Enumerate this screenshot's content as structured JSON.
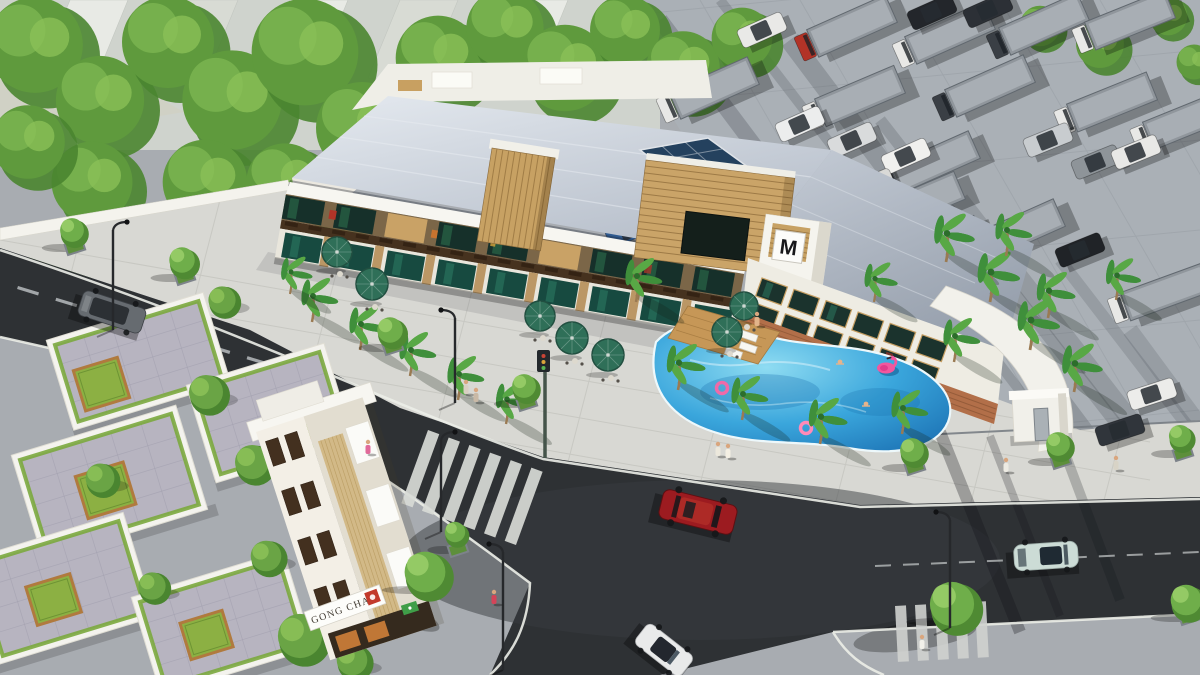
{
  "scene_title": "Aerial 3D architectural rendering: mixed-use commercial building with pool, street corner, villas and truck parking lot",
  "signs": {
    "shop_sign": "GONG CHA",
    "building_logo": "M"
  },
  "palette": {
    "asphalt": "#2e3134",
    "sidewalk": "#d8d8d3",
    "parking_lot": "#aab0b6",
    "pool_water": "#2e9ad2",
    "umbrella_green": "#2f6f58",
    "flamingo_pink": "#f2579e",
    "tree_green": "#5f9a3d",
    "palm_green": "#3f8f3b",
    "wood_slat": "#c9a266",
    "metal_roof": "#c3ccd7",
    "villa_paver": "#b7b4c0",
    "courtyard_green": "#8cb043",
    "red_car": "#9c1b20",
    "convertible_car": "#ccdcd6",
    "sports_car": "#e9eaea",
    "minivan": "#666b70",
    "truck_gray": "#90969c"
  },
  "vehicles": {
    "box_trucks": [
      {
        "x": 852,
        "y": 26,
        "a": -24,
        "cab": "#b23327"
      },
      {
        "x": 950,
        "y": 33,
        "a": -24,
        "cab": "#e8e8e6"
      },
      {
        "x": 1044,
        "y": 24,
        "a": -24,
        "cab": "#3a3f45"
      },
      {
        "x": 1130,
        "y": 20,
        "a": -22,
        "cab": "#e8e8e6"
      },
      {
        "x": 714,
        "y": 88,
        "a": -24,
        "cab": "#e8e8e6"
      },
      {
        "x": 860,
        "y": 96,
        "a": -23,
        "cab": "#e8e8e6"
      },
      {
        "x": 990,
        "y": 86,
        "a": -24,
        "cab": "#3a3f45"
      },
      {
        "x": 1112,
        "y": 102,
        "a": -22,
        "cab": "#e8e8e6"
      },
      {
        "x": 692,
        "y": 176,
        "a": -25,
        "cab": "#e8e8e6"
      },
      {
        "x": 935,
        "y": 162,
        "a": -24,
        "cab": "#3a3f45"
      },
      {
        "x": 772,
        "y": 240,
        "a": -24,
        "cab": "#e8e8e6"
      },
      {
        "x": 940,
        "y": 246,
        "a": -23,
        "cab": "#e8e8e6"
      },
      {
        "x": 1020,
        "y": 230,
        "a": -24,
        "cab": "#3a3f45"
      },
      {
        "x": 1166,
        "y": 292,
        "a": -20,
        "cab": "#e8e8e6"
      },
      {
        "x": 920,
        "y": 202,
        "a": -23,
        "cab": "#c8ccd0"
      },
      {
        "x": 1188,
        "y": 120,
        "a": -22,
        "cab": "#e8e8e6"
      }
    ],
    "small_vehicles": [
      {
        "x": 762,
        "y": 30,
        "a": -24,
        "c": "#e9e9e7"
      },
      {
        "x": 800,
        "y": 124,
        "a": -24,
        "c": "#eceded"
      },
      {
        "x": 852,
        "y": 140,
        "a": -24,
        "c": "#d9dbdc"
      },
      {
        "x": 906,
        "y": 156,
        "a": -24,
        "c": "#f0f0ee"
      },
      {
        "x": 932,
        "y": 12,
        "a": -24,
        "c": "#23262b"
      },
      {
        "x": 988,
        "y": 10,
        "a": -24,
        "c": "#2c3036"
      },
      {
        "x": 1048,
        "y": 140,
        "a": -22,
        "c": "#c8cccf"
      },
      {
        "x": 1096,
        "y": 162,
        "a": -22,
        "c": "#8e9499"
      },
      {
        "x": 630,
        "y": 230,
        "a": -25,
        "c": "#2f5a8f"
      },
      {
        "x": 870,
        "y": 186,
        "a": -23,
        "c": "#d9d9d7"
      },
      {
        "x": 1136,
        "y": 152,
        "a": -22,
        "c": "#e8e8e6"
      },
      {
        "x": 1152,
        "y": 394,
        "a": -18,
        "c": "#ececea"
      },
      {
        "x": 1080,
        "y": 250,
        "a": -22,
        "c": "#202327"
      },
      {
        "x": 1120,
        "y": 430,
        "a": -18,
        "c": "#30353b"
      }
    ],
    "road_cars": {
      "red_suv": {
        "x": 698,
        "y": 512,
        "a": 14,
        "c": "#9c1b20"
      },
      "convertible": {
        "x": 1046,
        "y": 556,
        "a": -4,
        "c": "#ccdcd6"
      },
      "sports_car": {
        "x": 664,
        "y": 650,
        "a": 38,
        "c": "#e9eaea"
      },
      "minivan": {
        "x": 112,
        "y": 312,
        "a": 18,
        "c": "#666b70"
      }
    }
  },
  "vegetation": {
    "forest": [
      {
        "x": 35,
        "y": 45,
        "r": 52
      },
      {
        "x": 100,
        "y": 100,
        "r": 48
      },
      {
        "x": 168,
        "y": 42,
        "r": 50
      },
      {
        "x": 232,
        "y": 100,
        "r": 54
      },
      {
        "x": 305,
        "y": 52,
        "r": 58
      },
      {
        "x": 362,
        "y": 128,
        "r": 50
      },
      {
        "x": 92,
        "y": 182,
        "r": 44
      },
      {
        "x": 28,
        "y": 142,
        "r": 40
      },
      {
        "x": 205,
        "y": 182,
        "r": 46
      },
      {
        "x": 285,
        "y": 182,
        "r": 42
      },
      {
        "x": 152,
        "y": 240,
        "r": 38
      },
      {
        "x": 58,
        "y": 250,
        "r": 33
      },
      {
        "x": 245,
        "y": 248,
        "r": 36
      },
      {
        "x": 330,
        "y": 245,
        "r": 33
      },
      {
        "x": 438,
        "y": 58,
        "r": 46
      },
      {
        "x": 505,
        "y": 28,
        "r": 42
      },
      {
        "x": 565,
        "y": 68,
        "r": 47
      },
      {
        "x": 625,
        "y": 30,
        "r": 38
      },
      {
        "x": 683,
        "y": 68,
        "r": 40
      },
      {
        "x": 742,
        "y": 38,
        "r": 33
      },
      {
        "x": 1040,
        "y": 26,
        "r": 22
      },
      {
        "x": 1100,
        "y": 44,
        "r": 26
      },
      {
        "x": 1168,
        "y": 16,
        "r": 21
      },
      {
        "x": 1194,
        "y": 62,
        "r": 19
      }
    ],
    "street_trees": [
      {
        "x": 72,
        "y": 238,
        "r": 14
      },
      {
        "x": 182,
        "y": 268,
        "r": 15
      },
      {
        "x": 390,
        "y": 338,
        "r": 15
      },
      {
        "x": 524,
        "y": 394,
        "r": 14
      },
      {
        "x": 912,
        "y": 458,
        "r": 14
      },
      {
        "x": 1058,
        "y": 452,
        "r": 14
      },
      {
        "x": 1180,
        "y": 444,
        "r": 13
      },
      {
        "x": 952,
        "y": 612,
        "r": 26
      },
      {
        "x": 1186,
        "y": 608,
        "r": 18
      },
      {
        "x": 425,
        "y": 580,
        "r": 24
      },
      {
        "x": 455,
        "y": 540,
        "r": 12
      }
    ],
    "garden_trees": [
      {
        "x": 206,
        "y": 392,
        "r": 20
      },
      {
        "x": 252,
        "y": 462,
        "r": 20
      },
      {
        "x": 100,
        "y": 478,
        "r": 17
      },
      {
        "x": 266,
        "y": 556,
        "r": 18
      },
      {
        "x": 152,
        "y": 586,
        "r": 16
      },
      {
        "x": 300,
        "y": 636,
        "r": 26
      },
      {
        "x": 352,
        "y": 660,
        "r": 18
      },
      {
        "x": 222,
        "y": 300,
        "r": 16
      }
    ],
    "palms": [
      {
        "x": 312,
        "y": 322,
        "s": 1
      },
      {
        "x": 360,
        "y": 350,
        "s": 1
      },
      {
        "x": 410,
        "y": 376,
        "s": 1
      },
      {
        "x": 458,
        "y": 400,
        "s": 1
      },
      {
        "x": 506,
        "y": 424,
        "s": 0.95
      },
      {
        "x": 290,
        "y": 294,
        "s": 0.85
      },
      {
        "x": 636,
        "y": 302,
        "s": 1
      },
      {
        "x": 678,
        "y": 390,
        "s": 1.05
      },
      {
        "x": 742,
        "y": 420,
        "s": 1
      },
      {
        "x": 820,
        "y": 444,
        "s": 1.05
      },
      {
        "x": 874,
        "y": 302,
        "s": 0.9
      },
      {
        "x": 902,
        "y": 434,
        "s": 1
      },
      {
        "x": 946,
        "y": 262,
        "s": 1.1
      },
      {
        "x": 990,
        "y": 302,
        "s": 1.15
      },
      {
        "x": 1030,
        "y": 350,
        "s": 1.15
      },
      {
        "x": 1074,
        "y": 392,
        "s": 1.1
      },
      {
        "x": 1006,
        "y": 256,
        "s": 1
      },
      {
        "x": 1048,
        "y": 318,
        "s": 1.05
      },
      {
        "x": 954,
        "y": 362,
        "s": 1
      },
      {
        "x": 1116,
        "y": 300,
        "s": 0.95
      }
    ]
  },
  "villas": [
    {
      "x": 55,
      "y": 345,
      "w": 150,
      "h": 80,
      "court": [
        10,
        30,
        46,
        42
      ]
    },
    {
      "x": 195,
      "y": 390,
      "w": 130,
      "h": 88,
      "court": [
        62,
        42,
        44,
        38
      ]
    },
    {
      "x": 20,
      "y": 460,
      "w": 158,
      "h": 95,
      "court": [
        48,
        32,
        50,
        44
      ]
    },
    {
      "x": -25,
      "y": 565,
      "w": 150,
      "h": 95,
      "court": [
        42,
        36,
        46,
        40
      ]
    },
    {
      "x": 140,
      "y": 602,
      "w": 145,
      "h": 88,
      "court": [
        32,
        32,
        44,
        38
      ]
    }
  ],
  "furniture": {
    "umbrellas": [
      {
        "x": 337,
        "y": 252,
        "r": 15
      },
      {
        "x": 372,
        "y": 284,
        "r": 16
      },
      {
        "x": 540,
        "y": 316,
        "r": 15
      },
      {
        "x": 572,
        "y": 338,
        "r": 16
      },
      {
        "x": 608,
        "y": 355,
        "r": 16
      },
      {
        "x": 744,
        "y": 306,
        "r": 14
      },
      {
        "x": 727,
        "y": 332,
        "r": 15
      }
    ],
    "lamps": [
      {
        "x": 113,
        "y": 330,
        "h": 100,
        "dir": 1
      },
      {
        "x": 455,
        "y": 403,
        "h": 85,
        "dir": -1
      },
      {
        "x": 503,
        "y": 670,
        "h": 118,
        "dir": -1
      },
      {
        "x": 950,
        "y": 628,
        "h": 108,
        "dir": -1
      },
      {
        "x": 441,
        "y": 532,
        "h": 92,
        "dir": 1
      }
    ]
  },
  "people": [
    {
      "x": 718,
      "y": 448,
      "c": "#ece8dc"
    },
    {
      "x": 728,
      "y": 450,
      "c": "#f4efe3"
    },
    {
      "x": 466,
      "y": 386,
      "c": "#d9cfc2"
    },
    {
      "x": 476,
      "y": 394,
      "c": "#c9b9a6"
    },
    {
      "x": 368,
      "y": 446,
      "c": "#e06a9a"
    },
    {
      "x": 494,
      "y": 596,
      "c": "#d44458"
    },
    {
      "x": 922,
      "y": 641,
      "c": "#f1f0e9"
    },
    {
      "x": 1006,
      "y": 464,
      "c": "#edebe3"
    },
    {
      "x": 757,
      "y": 318,
      "c": "#e2b48a"
    },
    {
      "x": 1116,
      "y": 462,
      "c": "#d8d3c6"
    }
  ],
  "pool": {
    "flamingo": {
      "x": 886,
      "y": 368
    },
    "rings": [
      {
        "x": 722,
        "y": 388,
        "c": "#f06aa8"
      },
      {
        "x": 806,
        "y": 428,
        "c": "#ff8ab8"
      }
    ],
    "swimmers": [
      {
        "x": 840,
        "y": 362
      },
      {
        "x": 866,
        "y": 404
      }
    ]
  }
}
